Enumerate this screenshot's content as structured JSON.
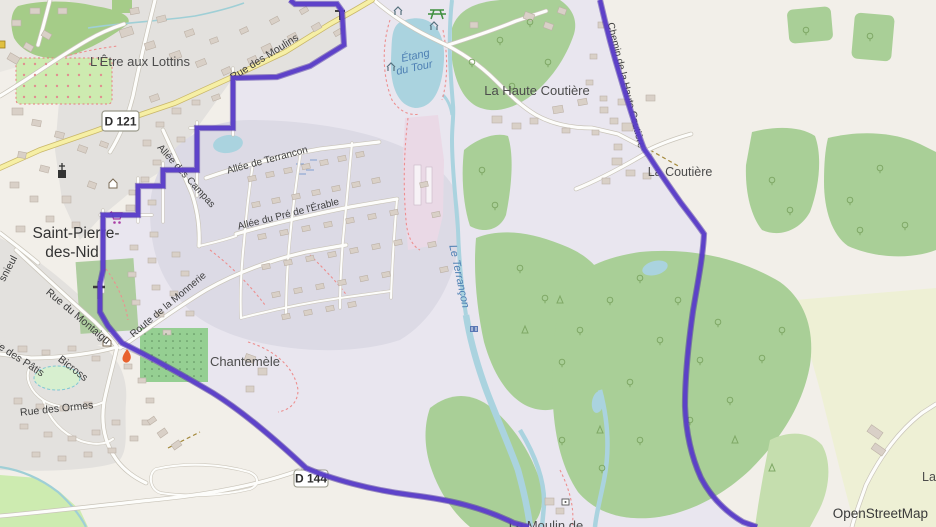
{
  "map": {
    "attribution": "OpenStreetMap",
    "badges": {
      "d121": "D 121",
      "d144": "D 144"
    },
    "labels": {
      "hamlet_lottins": "L'Être aux Lottins",
      "town_line1": "Saint-Pierre-",
      "town_line2": "des-Nid",
      "rue_du_montaigu": "Rue du Montaigu",
      "snieul": "snieul",
      "rue_des_patis": "Rue des Pâtis",
      "bicross": "Bicross",
      "rue_des_ormes": "Rue des Ormes",
      "rue_des_moulins": "Rue des Moulins",
      "allee_des_campas": "Allée des Campas",
      "allee_de_terrancon": "Allée de Terrancon",
      "allee_du_pre": "Allée du Pré de l'Érable",
      "route_de_la_monnerie": "Route de la Monnerie",
      "chantemele": "Chantemèle",
      "etang_line1": "Étang",
      "etang_line2": "du Tour",
      "la_haute_coutiere": "La Haute Coutière",
      "la_coutiere": "La Coutière",
      "chemin_haute_coutiere": "Chemin de la Haute Coutière",
      "le_terrancon": "Le Terrançon",
      "le_moulin": "Le Moulin de",
      "la_partial": "La"
    },
    "icons": [
      "church-icon",
      "wayside-cross-icon",
      "cemetery-cross-icon",
      "supermarket-cart-icon",
      "fire-icon",
      "picnic-table-icon",
      "shelter-icon",
      "weir-icon",
      "shrine-icon"
    ],
    "colors": {
      "route": "#5b3ec9",
      "route_halo": "#44299f",
      "water": "#aad3df",
      "forest": "#a9cf97",
      "road_yellow": "#f6efa5",
      "residential": "#e3e1de",
      "route_area": "#e9e6ef",
      "development": "#dcdae5"
    }
  }
}
